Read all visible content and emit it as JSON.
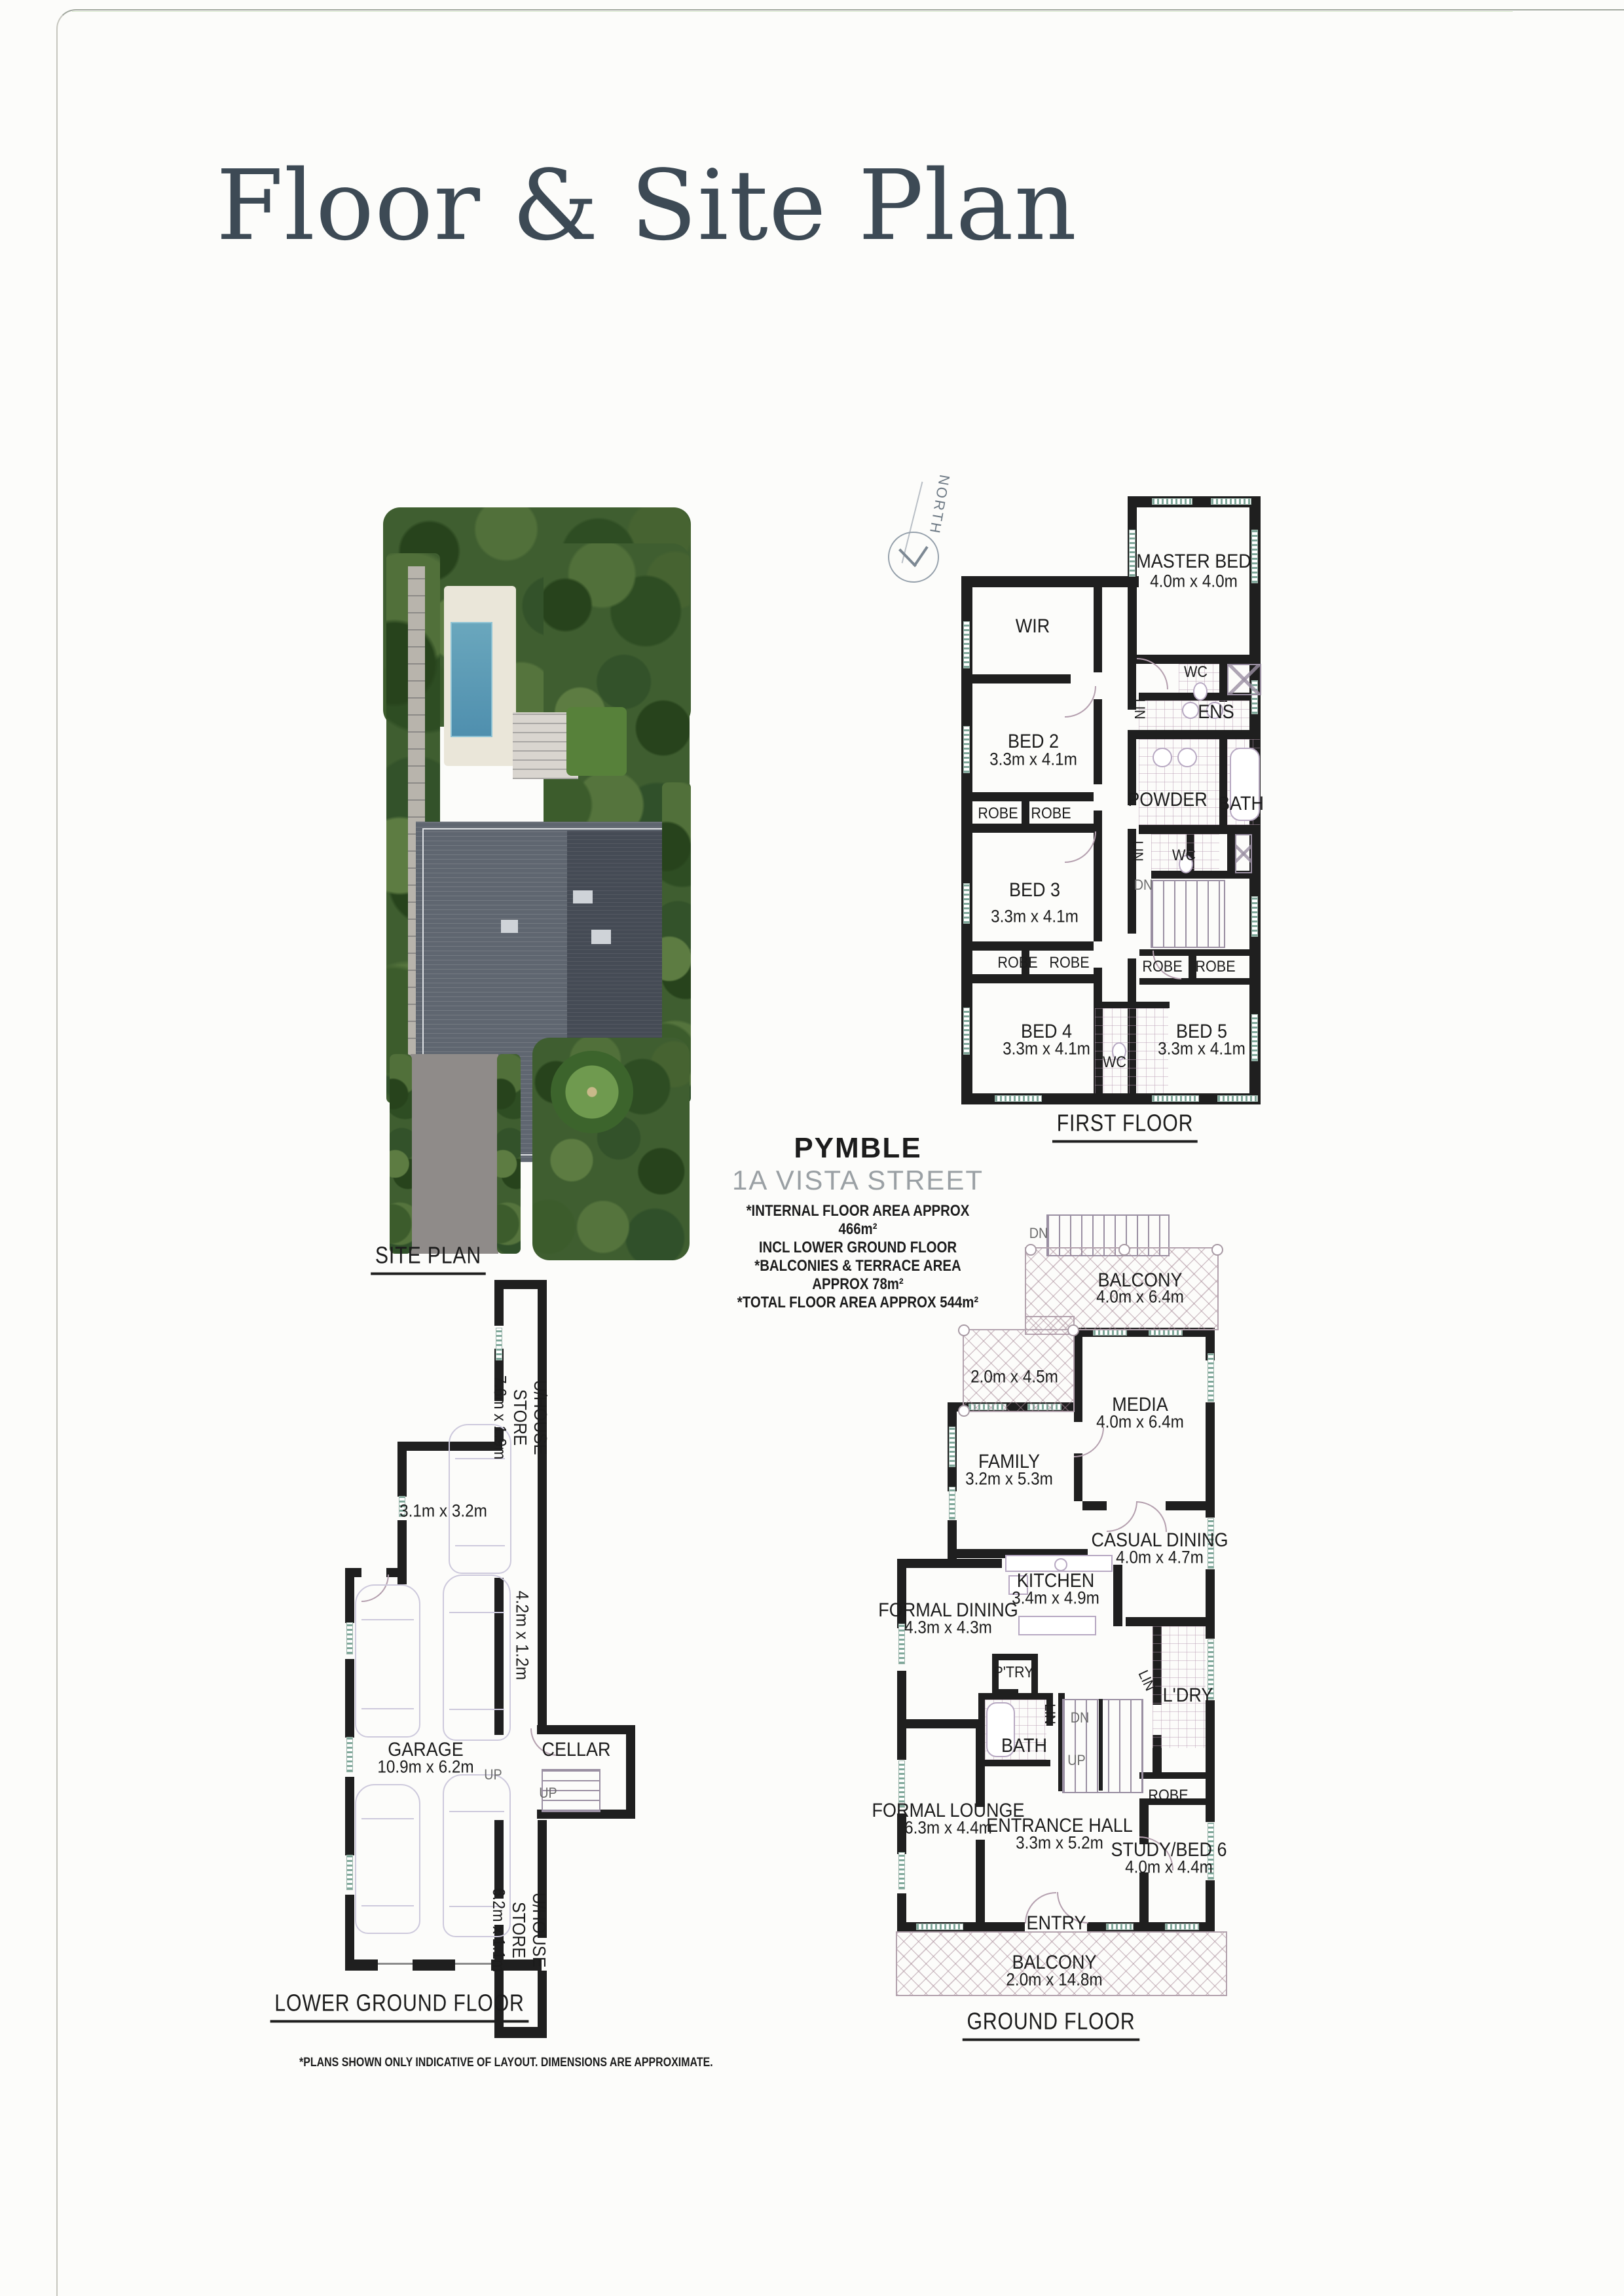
{
  "page_title": "Floor & Site Plan",
  "property": {
    "suburb": "PYMBLE",
    "address": "1A VISTA STREET",
    "area_notes": [
      "*INTERNAL FLOOR AREA APPROX 466m²",
      "INCL LOWER GROUND FLOOR",
      "*BALCONIES & TERRACE AREA APPROX 78m²",
      "*TOTAL FLOOR AREA APPROX 544m²"
    ]
  },
  "north_label": "NORTH",
  "site_plan_label": "SITE PLAN",
  "first_floor": {
    "label": "FIRST FLOOR",
    "rooms": {
      "master": {
        "name": "MASTER BED",
        "dims": "4.0m x 4.0m"
      },
      "wir": "WIR",
      "bed2": {
        "name": "BED 2",
        "dims": "3.3m x 4.1m"
      },
      "bed3": {
        "name": "BED 3",
        "dims": "3.3m x 4.1m"
      },
      "bed4": {
        "name": "BED 4",
        "dims": "3.3m x 4.1m"
      },
      "bed5": {
        "name": "BED 5",
        "dims": "3.3m x 4.1m"
      },
      "powder": "POWDER",
      "bath": "BATH",
      "ens": "ENS",
      "wc": "WC",
      "robe": "ROBE",
      "lin": "LIN",
      "dn": "DN"
    }
  },
  "ground_floor": {
    "label": "GROUND FLOOR",
    "rooms": {
      "balcony_top": {
        "name": "BALCONY",
        "dims": "4.0m x 6.4m"
      },
      "terrace_dims": "2.0m x 4.5m",
      "media": {
        "name": "MEDIA",
        "dims": "4.0m x 6.4m"
      },
      "family": {
        "name": "FAMILY",
        "dims": "3.2m x 5.3m"
      },
      "casual": {
        "name": "CASUAL DINING",
        "dims": "4.0m x 4.7m"
      },
      "kitchen": {
        "name": "KITCHEN",
        "dims": "3.4m x 4.9m"
      },
      "formal_dining": {
        "name": "FORMAL DINING",
        "dims": "4.3m x 4.3m"
      },
      "pantry": "P'TRY",
      "bath": "BATH",
      "lin": "LIN",
      "laundry": "L'DRY",
      "dn": "DN",
      "up": "UP",
      "formal_lounge": {
        "name": "FORMAL LOUNGE",
        "dims": "6.3m x 4.4m"
      },
      "entrance": {
        "name": "ENTRANCE HALL",
        "dims": "3.3m x 5.2m"
      },
      "robe": "ROBE",
      "study": {
        "name": "STUDY/BED 6",
        "dims": "4.0m x 4.4m"
      },
      "entry": "ENTRY",
      "balcony_bottom": {
        "name": "BALCONY",
        "dims": "2.0m x 14.8m"
      }
    }
  },
  "lower_ground": {
    "label": "LOWER GROUND FLOOR",
    "rooms": {
      "store_top": {
        "name": "U/HOUSE STORE",
        "dims": "7.6m x 1.9m"
      },
      "store_room_dims": "3.1m x 3.2m",
      "garage": {
        "name": "GARAGE",
        "dims": "10.9m x 6.2m"
      },
      "strip_dims": "4.2m x 1.2m",
      "cellar": "CELLAR",
      "up": "UP",
      "store_bottom": {
        "name": "U/HOUSE STORE",
        "dims": "6.2m x 1.1m"
      }
    }
  },
  "disclaimer": "*PLANS SHOWN ONLY INDICATIVE OF LAYOUT. DIMENSIONS ARE APPROXIMATE."
}
